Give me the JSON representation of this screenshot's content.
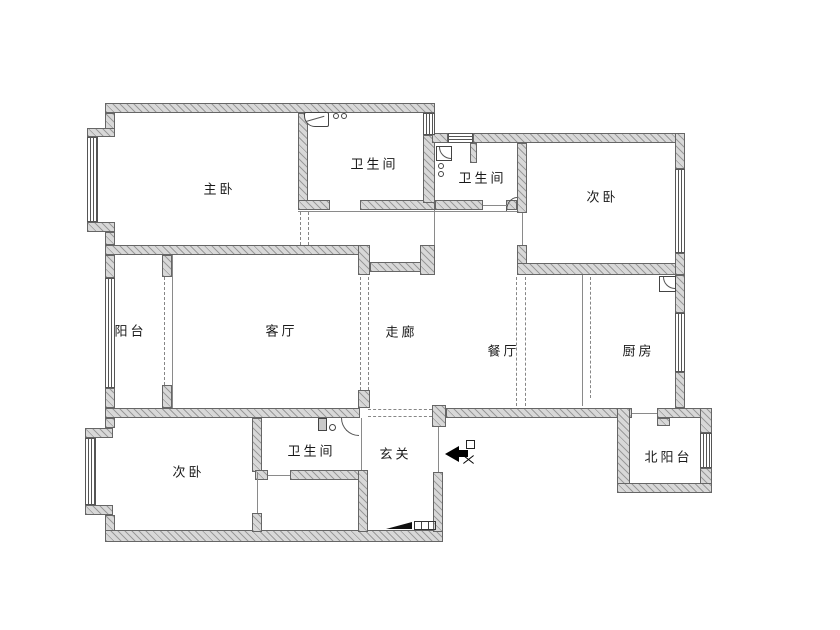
{
  "canvas": {
    "width": 840,
    "height": 630,
    "background": "#ffffff"
  },
  "palette": {
    "wall_fill": "#d8d8d8",
    "wall_hatch": "#9a9a9a",
    "wall_outline": "#666666",
    "thin_line": "#8a8a8a",
    "dashed_opening": "#868686",
    "label_color": "#1a1a1a",
    "entrance_arrow": "#000000"
  },
  "rooms": [
    {
      "id": "master-bedroom",
      "label": "主卧"
    },
    {
      "id": "bathroom-top",
      "label": "卫生间"
    },
    {
      "id": "bathroom-mid",
      "label": "卫生间"
    },
    {
      "id": "bedroom-northeast",
      "label": "次卧"
    },
    {
      "id": "balcony",
      "label": "阳台"
    },
    {
      "id": "living-room",
      "label": "客厅"
    },
    {
      "id": "corridor",
      "label": "走廊"
    },
    {
      "id": "dining-room",
      "label": "餐厅"
    },
    {
      "id": "kitchen",
      "label": "厨房"
    },
    {
      "id": "bedroom-southwest",
      "label": "次卧"
    },
    {
      "id": "bathroom-south",
      "label": "卫生间"
    },
    {
      "id": "entry-hall",
      "label": "玄关"
    },
    {
      "id": "north-balcony",
      "label": "北阳台"
    }
  ],
  "icons": [
    "entrance-arrow-icon",
    "entry-door-symbol-icon",
    "entry-door-leaf-icon",
    "shoe-cabinet-icon",
    "sink-icon",
    "corner-basin-icon",
    "toilet-icon",
    "door-swing-arc",
    "window",
    "wall-segment"
  ]
}
